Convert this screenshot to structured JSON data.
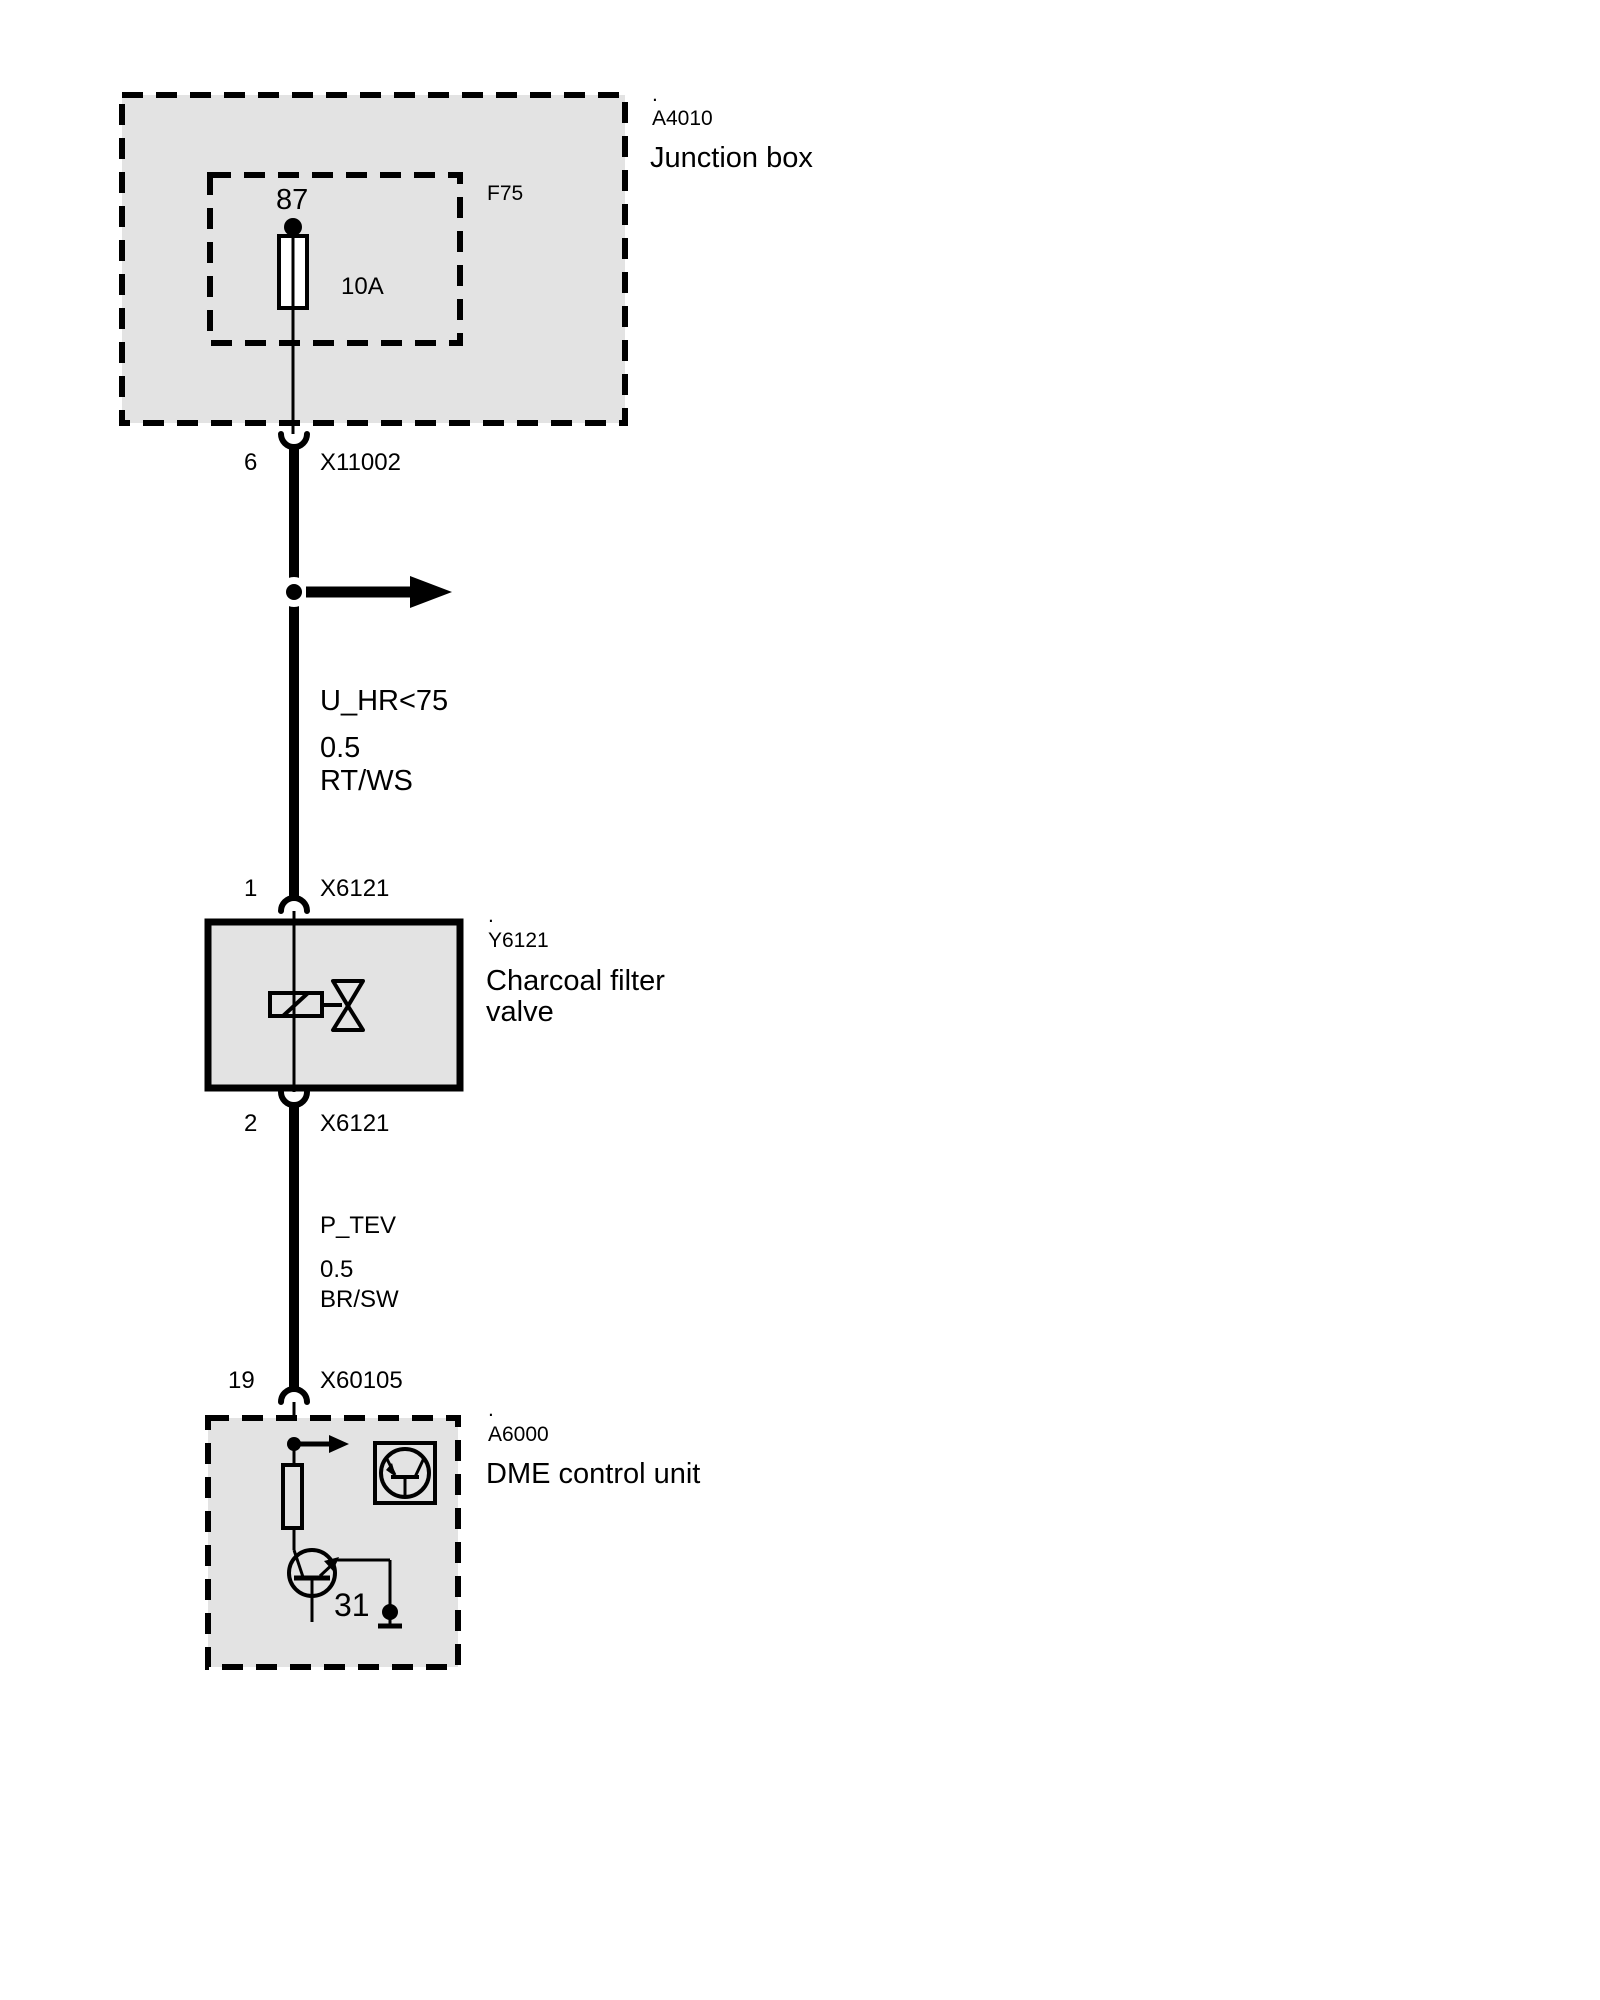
{
  "colors": {
    "background": "#ffffff",
    "box_fill": "#e3e3e3",
    "line": "#000000"
  },
  "junction_box": {
    "dot": ".",
    "id": "A4010",
    "title": "Junction box",
    "fuse": {
      "box_id": "F75",
      "terminal": "87",
      "rating": "10A"
    }
  },
  "upper_connector": {
    "pin": "6",
    "id": "X11002"
  },
  "wire_upper": {
    "signal": "U_HR<75",
    "cross_section": "0.5",
    "color_code": "RT/WS"
  },
  "valve": {
    "pin_in": "1",
    "connector_in": "X6121",
    "dot": ".",
    "id": "Y6121",
    "title": "Charcoal filter valve",
    "pin_out": "2",
    "connector_out": "X6121"
  },
  "wire_lower": {
    "signal": "P_TEV",
    "cross_section": "0.5",
    "color_code": "BR/SW"
  },
  "dme": {
    "pin": "19",
    "connector": "X60105",
    "dot": ".",
    "id": "A6000",
    "title": "DME control unit",
    "ground_terminal": "31"
  }
}
